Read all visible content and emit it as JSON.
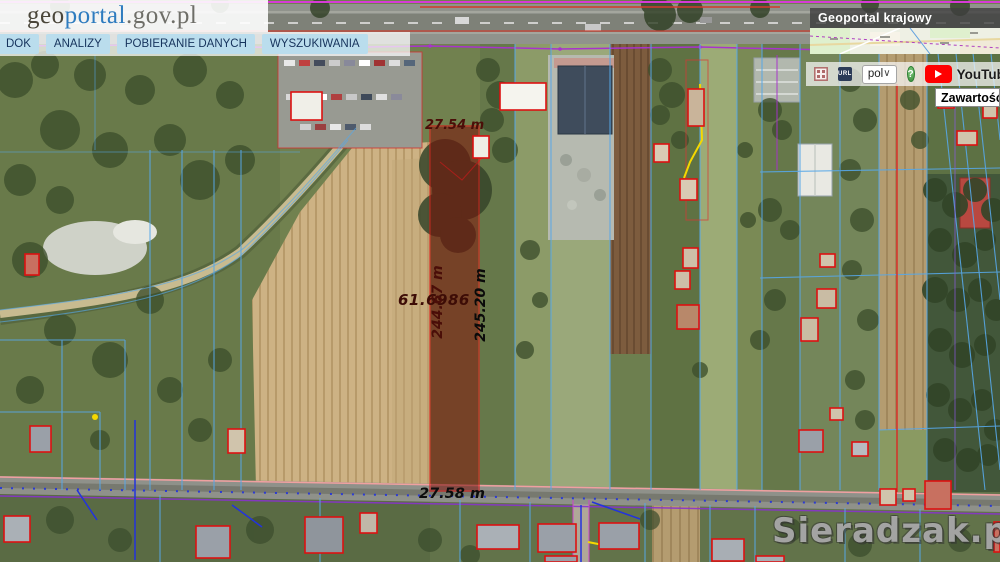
{
  "branding": {
    "logo_geo": "geo",
    "logo_portal": "portal",
    "logo_suffix": ".gov.pl"
  },
  "menu": {
    "items": [
      {
        "label": "DOK"
      },
      {
        "label": "ANALIZY"
      },
      {
        "label": "POBIERANIE DANYCH"
      },
      {
        "label": "WYSZUKIWANIA"
      }
    ]
  },
  "overlay_map": {
    "title": "Geoportal krajowy"
  },
  "toolbar": {
    "legend_icon": "legend-grid-icon",
    "url_icon_label": "URL",
    "language_value": "pol",
    "help_label": "?",
    "youtube_label": "YouTube"
  },
  "side_panel": {
    "title_partial": "Zawartość m"
  },
  "measurements": {
    "top_edge": "27.54 m",
    "bottom_edge": "27.58 m",
    "left_edge": "244.67 m",
    "right_edge": "245.20 m",
    "area_value": "61.6986"
  },
  "watermark": {
    "text": "Sieradzak.pl"
  },
  "colors": {
    "parcel_highlight_fill": "#7a1008",
    "parcel_outline": "#dd1111",
    "cadastral_blue": "#57a8e8",
    "cadastral_magenta": "#a833cc",
    "menu_button_bg": "#badded",
    "youtube_red": "#ff0000",
    "help_green": "#3f8f3f"
  }
}
